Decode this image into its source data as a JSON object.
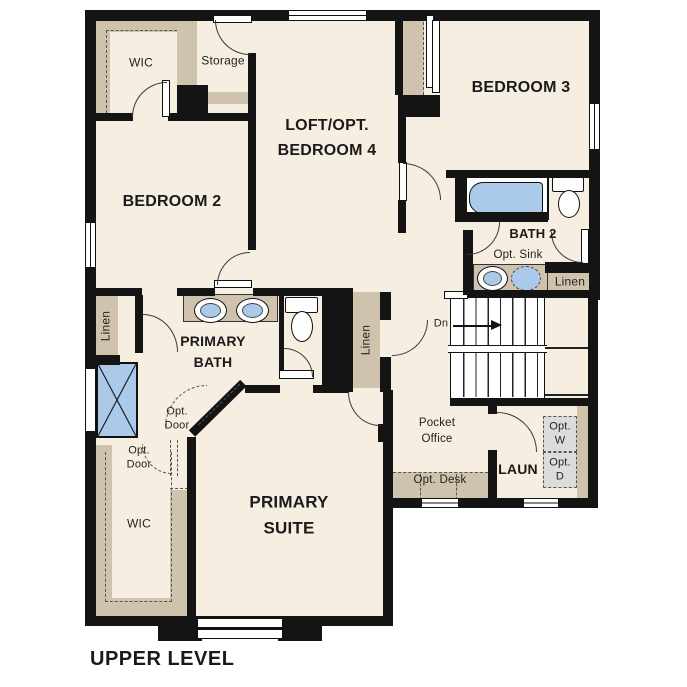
{
  "title": "UPPER LEVEL",
  "plan": {
    "rooms": {
      "wic_upper": "WIC",
      "storage": "Storage",
      "loft": "LOFT/OPT.\nBEDROOM 4",
      "bedroom2": "BEDROOM 2",
      "bedroom3": "BEDROOM 3",
      "bath2": "BATH 2",
      "primary_bath": "PRIMARY\nBATH",
      "primary_suite": "PRIMARY\nSUITE",
      "pocket_office": "Pocket\nOffice",
      "laundry": "LAUN",
      "wic_lower": "WIC"
    },
    "features": {
      "opt_sink": "Opt. Sink",
      "linen_bath": "Linen",
      "linen_hall": "Linen",
      "linen_left": "Linen",
      "stairs_down": "Dn",
      "opt_door_bath": "Opt.\nDoor",
      "opt_door_wic": "Opt.\nDoor",
      "opt_desk": "Opt. Desk",
      "opt_washer": "Opt.\nW",
      "opt_dryer": "Opt.\nD"
    },
    "colors": {
      "floor": "#f6eee1",
      "closet_tan": "#cfc3ad",
      "fixture_blue": "#abc9e8",
      "wall_black": "#141414",
      "appliance_gray": "#dcdcdc"
    }
  }
}
